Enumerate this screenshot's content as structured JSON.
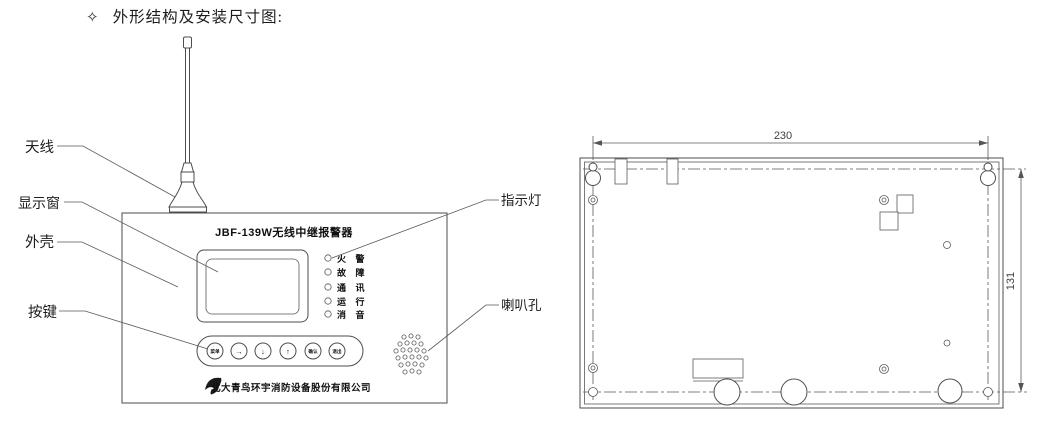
{
  "header": {
    "bullet": "✧",
    "title": "外形结构及安装尺寸图:"
  },
  "front_view": {
    "device_title": "JBF-139W无线中继报警器",
    "company": "北大青鸟环宇消防设备股份有限公司",
    "callouts": {
      "antenna": "天线",
      "display_window": "显示窗",
      "case": "外壳",
      "keys": "按键",
      "indicator_light": "指示灯",
      "speaker_hole": "喇叭孔"
    },
    "indicators": [
      "火警",
      "故障",
      "通讯",
      "运行",
      "消音"
    ],
    "buttons": [
      "菜单",
      "→",
      "↓",
      "↑",
      "确认",
      "退出"
    ]
  },
  "rear_view": {
    "width_mm": "230",
    "height_mm": "131"
  },
  "colors": {
    "line": "#4d4d4d",
    "text": "#1d1d1d",
    "background": "#ffffff"
  }
}
